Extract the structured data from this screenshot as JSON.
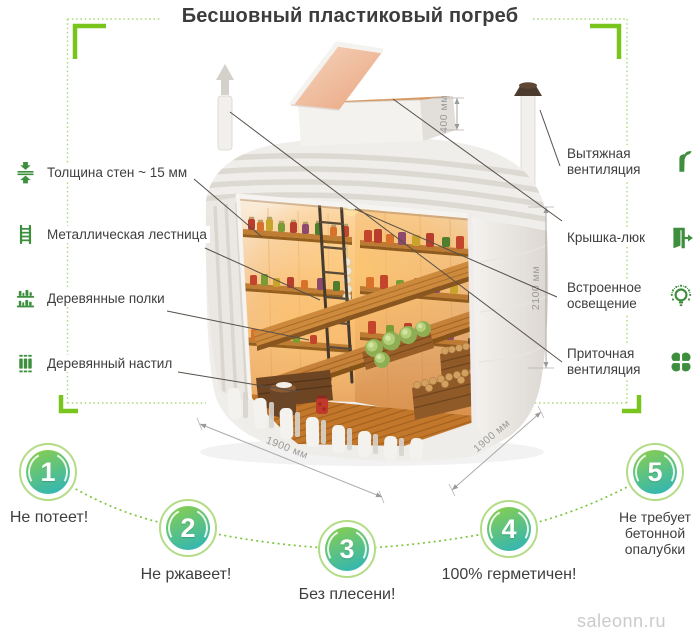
{
  "title": "Бесшовный пластиковый погреб",
  "left_labels": [
    {
      "label": "Толщина стен ~ 15 мм",
      "icon": "wall-thickness-icon"
    },
    {
      "label": "Металлическая лестница",
      "icon": "ladder-icon"
    },
    {
      "label": "Деревянные полки",
      "icon": "shelves-icon"
    },
    {
      "label": "Деревянный настил",
      "icon": "decking-icon"
    }
  ],
  "right_labels": [
    {
      "label": "Вытяжная вентиляция",
      "icon": "exhaust-vent-icon"
    },
    {
      "label": "Крышка-люк",
      "icon": "hatch-icon"
    },
    {
      "label": "Встроенное освещение",
      "icon": "lighting-icon"
    },
    {
      "label": "Приточная вентиляция",
      "icon": "supply-vent-icon"
    }
  ],
  "dimensions": {
    "lid": "400 мм",
    "height": "2100 мм",
    "width": "1900 мм",
    "depth": "1900 мм"
  },
  "features": [
    {
      "number": "1",
      "label": "Не потеет!"
    },
    {
      "number": "2",
      "label": "Не ржавеет!"
    },
    {
      "number": "3",
      "label": "Без плесени!"
    },
    {
      "number": "4",
      "label": "100% герметичен!"
    },
    {
      "number": "5",
      "label": "Не требует бетонной опалубки"
    }
  ],
  "watermark": "saleonn.ru",
  "colors": {
    "accent_green": "#79c41d",
    "dotted_green": "#a9d878",
    "icon_green": "#3d8f3d",
    "circle_gradient_top": "#8ccf4b",
    "circle_gradient_bottom": "#2ab4bc",
    "circle_ring": "#b3dc86",
    "text_dark": "#3e3e3e",
    "dimension_gray": "#9a9a9a",
    "watermark_gray": "#cbcbcb"
  }
}
